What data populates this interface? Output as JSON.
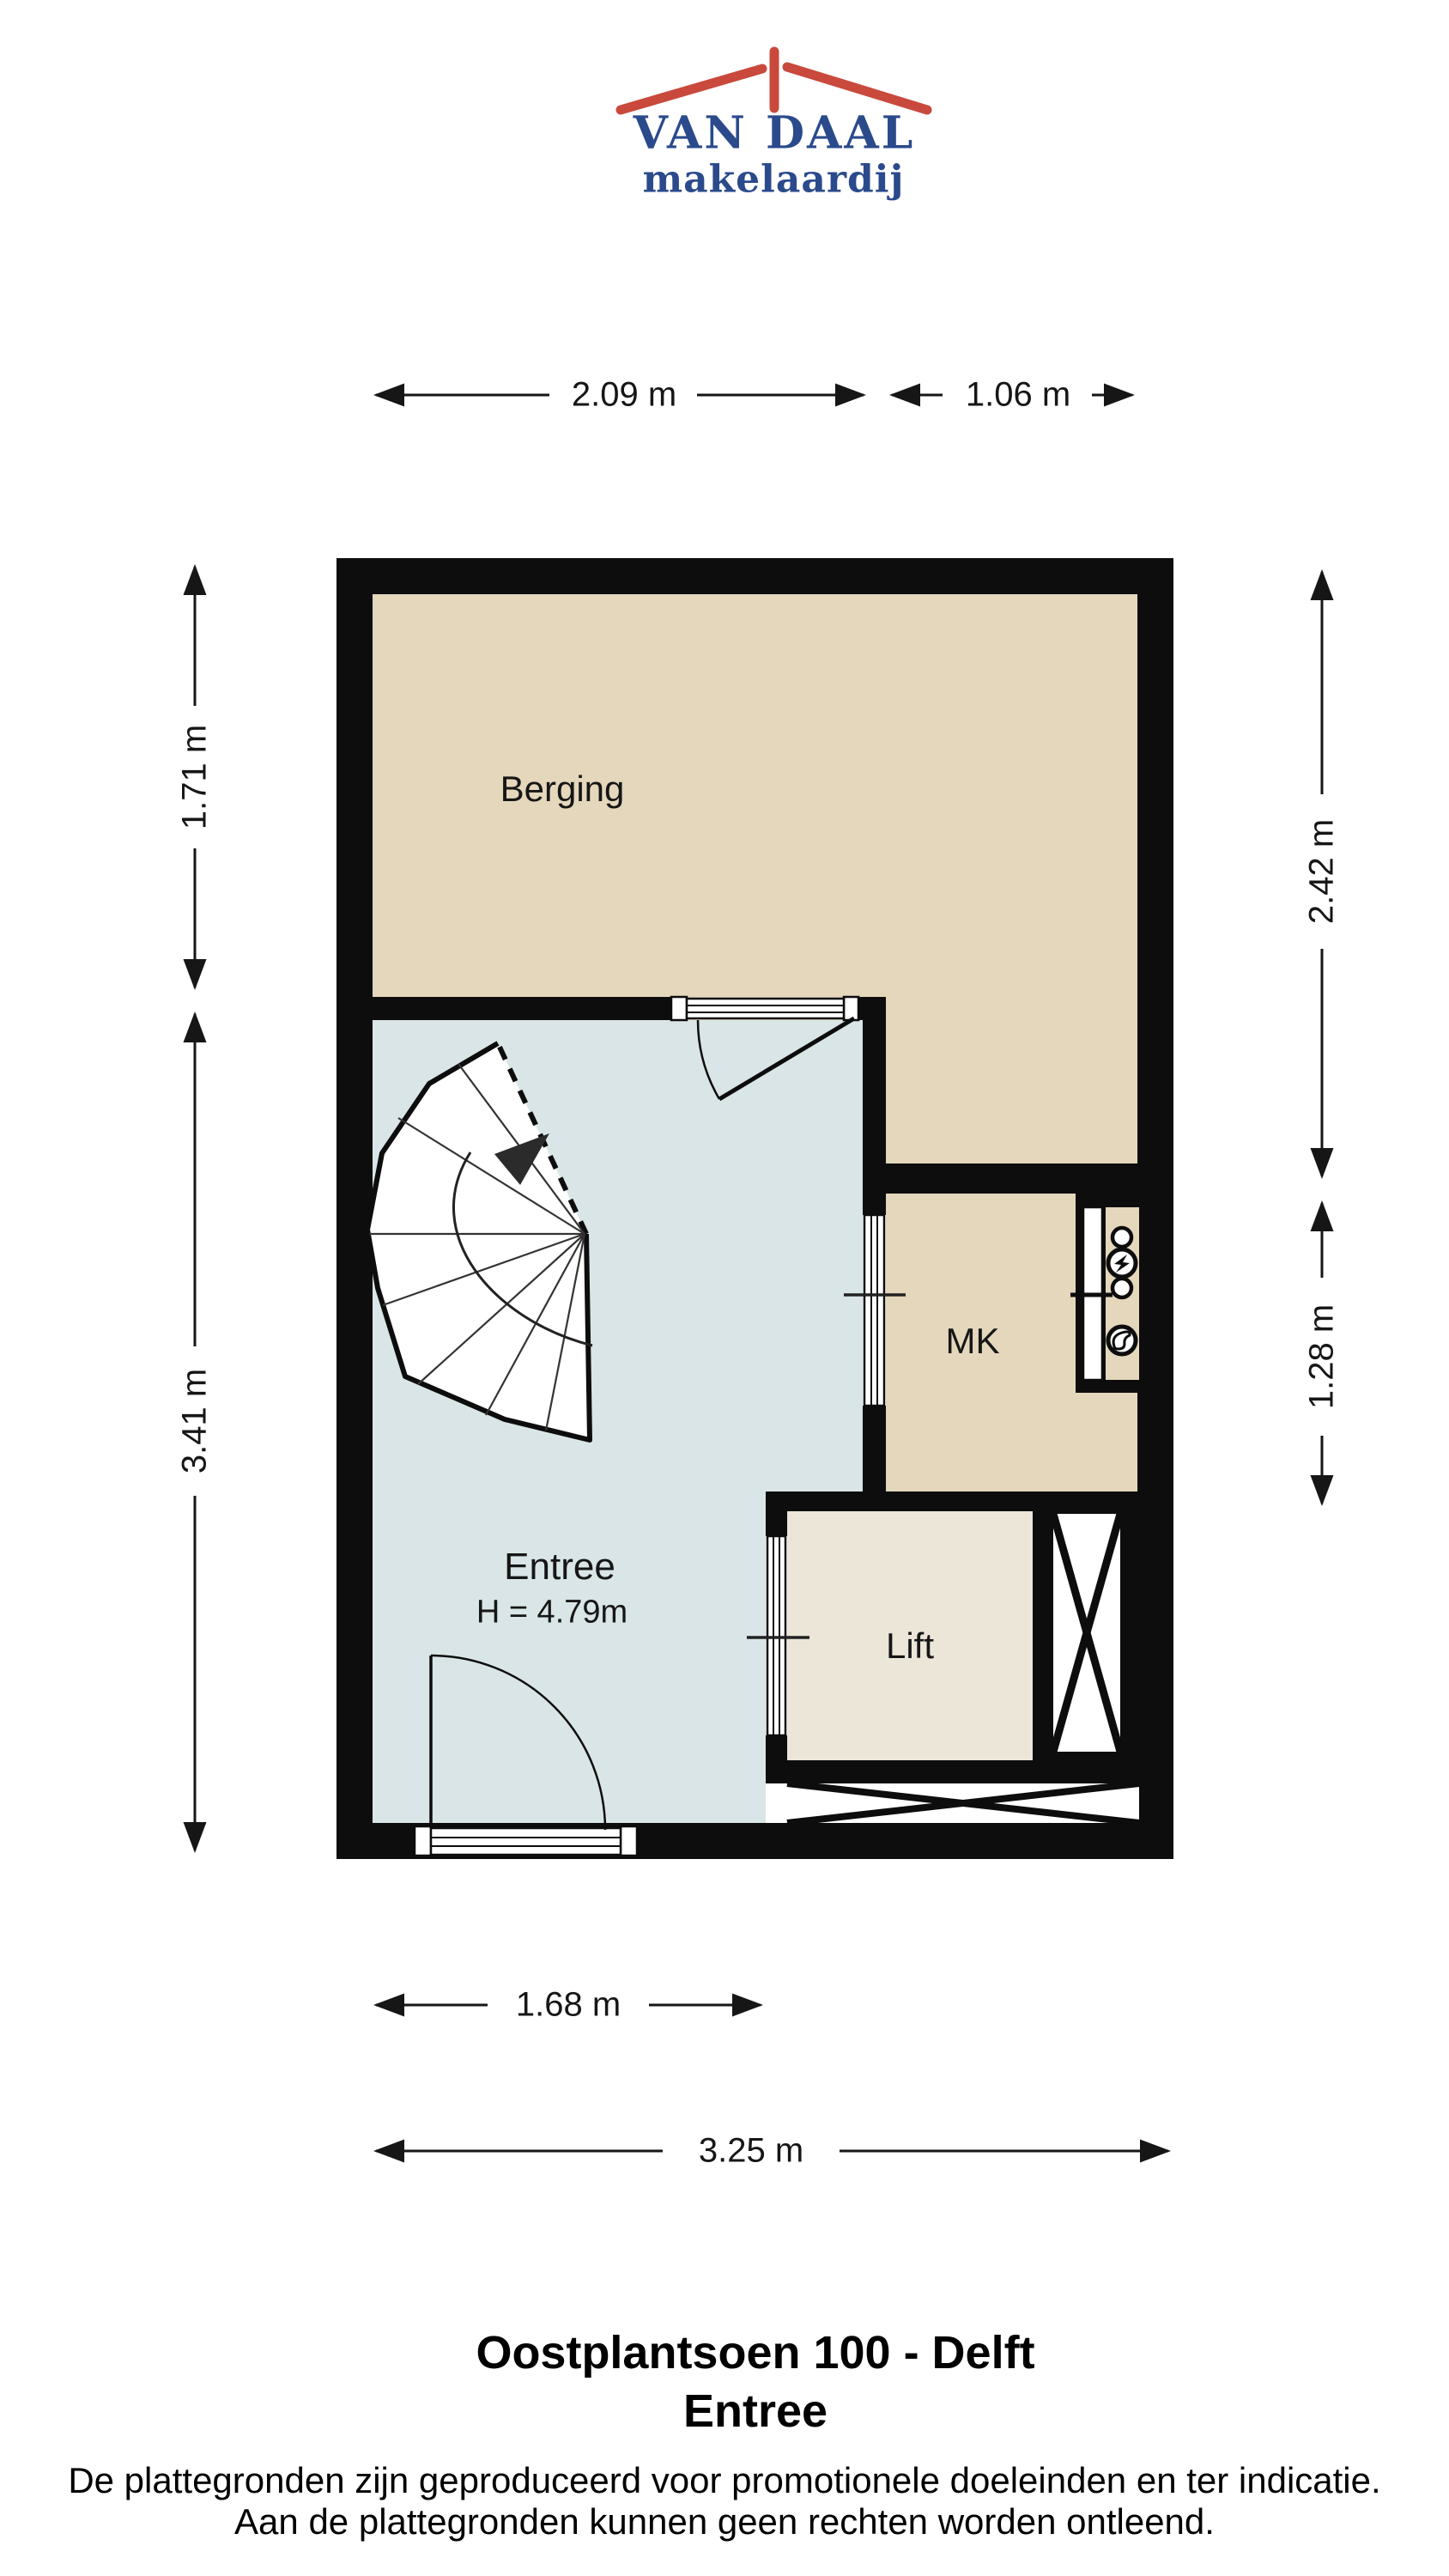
{
  "logo": {
    "name": "VAN DAAL",
    "tagline": "makelaardij",
    "text_color": "#2a4a8c",
    "roof_color": "#c9493c"
  },
  "plan": {
    "rooms": [
      {
        "id": "berging",
        "label": "Berging"
      },
      {
        "id": "mk",
        "label": "MK"
      },
      {
        "id": "lift",
        "label": "Lift"
      },
      {
        "id": "entree",
        "label": "Entree",
        "ceiling_height": "H = 4.79m"
      }
    ],
    "colors": {
      "wall": "#0d0d0d",
      "berging_fill": "#e4d7bc",
      "mk_fill": "#e4d7bc",
      "entree_fill": "#d9e5e6",
      "lift_fill": "#ece6d9"
    }
  },
  "dimensions": {
    "top": [
      "2.09 m",
      "1.06 m"
    ],
    "left": [
      "1.71 m",
      "3.41 m"
    ],
    "right": [
      "2.42 m",
      "1.28 m"
    ],
    "bottom": [
      "1.68 m",
      "3.25 m"
    ]
  },
  "icons": [
    {
      "name": "electricity-meter-icon",
      "shape": "circle-with-lightning-bolt"
    },
    {
      "name": "gas-meter-icon",
      "shape": "circle-with-flame"
    },
    {
      "name": "spiral-staircase",
      "shape": "fan-of-winder-steps-with-up-arrow"
    }
  ],
  "footer": {
    "title": "Oostplantsoen 100 - Delft",
    "subtitle": "Entree",
    "disclaimer_line1": "De plattegronden zijn geproduceerd voor promotionele doeleinden en ter indicatie.",
    "disclaimer_line2": "Aan de plattegronden kunnen geen rechten worden ontleend."
  }
}
